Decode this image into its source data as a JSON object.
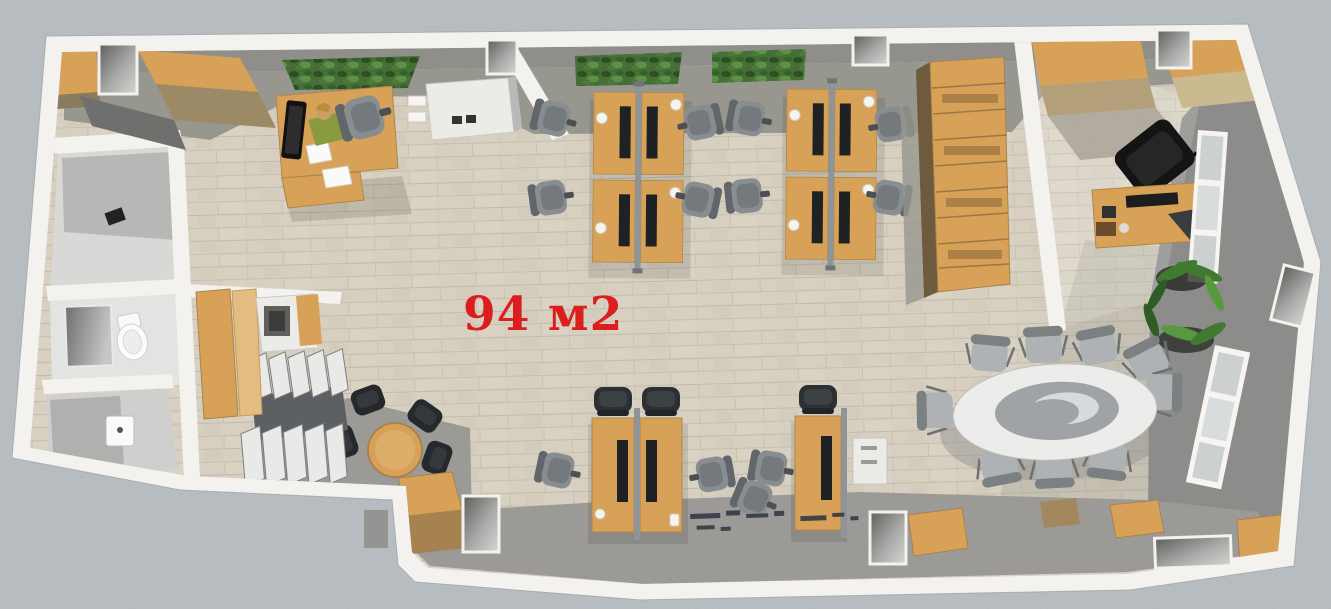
{
  "floor_plan": {
    "area_label": "94 м2"
  },
  "colors": {
    "background": "#b6bcc1",
    "wall": "#f3f2ee",
    "floor_wood": "#d7d0c1",
    "floor_gray": "#9b9a97",
    "wall_gray": "#8d8c8a",
    "wood": "#d7a258",
    "wood_dark": "#a5824f",
    "window_green": "#466f37",
    "chair_gray": "#888d90",
    "chair_dark": "#2e3234",
    "white_furniture": "#ebebe8",
    "glass": "#ccd0d1",
    "plant_green": "#3f7a2e",
    "skin": "#c99f63",
    "shirt_green": "#8a9a3e",
    "label_red": "#db1f1f"
  }
}
